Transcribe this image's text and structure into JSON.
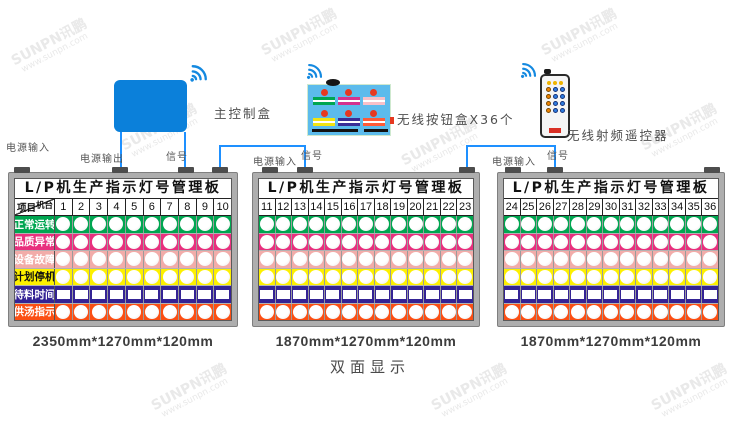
{
  "brand_watermark": {
    "line1": "SUNPN讯鹏",
    "line2": "www.sunpn.com"
  },
  "devices": {
    "control_box_label": "主控制盒",
    "button_box_label": "无线按钮盒X36个",
    "remote_label": "无线射频遥控器"
  },
  "wiring": {
    "power_in_1": "电源输入",
    "power_out": "电源输出",
    "signal_1": "信号",
    "power_in_2": "电源输入",
    "signal_2": "信号",
    "power_in_3": "电源输入",
    "signal_3": "信号"
  },
  "rows": [
    {
      "label": "正常运转",
      "color": "#00A651",
      "text": "#ffffff",
      "shape": "circle"
    },
    {
      "label": "品质异常",
      "color": "#E8307E",
      "text": "#ffffff",
      "shape": "circle"
    },
    {
      "label": "设备故障",
      "color": "#F2ACA9",
      "text": "#ffffff",
      "shape": "circle"
    },
    {
      "label": "计划停机",
      "color": "#FDF000",
      "text": "#111111",
      "shape": "circle"
    },
    {
      "label": "待料时间",
      "color": "#342395",
      "text": "#ffffff",
      "shape": "square"
    },
    {
      "label": "供汤指示",
      "color": "#FB4F14",
      "text": "#ffffff",
      "shape": "circle"
    }
  ],
  "boards": [
    {
      "title": "L/P机生产指示灯号管理板",
      "corner_top": "机台",
      "corner_bottom": "项目",
      "has_labels": true,
      "columns": [
        "1",
        "2",
        "3",
        "4",
        "5",
        "6",
        "7",
        "8",
        "9",
        "10"
      ],
      "dimension": "2350mm*1270mm*120mm"
    },
    {
      "title": "L/P机生产指示灯号管理板",
      "has_labels": false,
      "columns": [
        "11",
        "12",
        "13",
        "14",
        "15",
        "16",
        "17",
        "18",
        "19",
        "20",
        "21",
        "22",
        "23"
      ],
      "dimension": "1870mm*1270mm*120mm"
    },
    {
      "title": "L/P机生产指示灯号管理板",
      "has_labels": false,
      "columns": [
        "24",
        "25",
        "26",
        "27",
        "28",
        "29",
        "30",
        "31",
        "32",
        "33",
        "34",
        "35",
        "36"
      ],
      "dimension": "1870mm*1270mm*120mm"
    }
  ],
  "button_box": {
    "dot_color": "#E63920",
    "bar_colors": [
      "#00A651",
      "#D4328E",
      "#F8C0C8",
      "#F2E411",
      "#3A2E96",
      "#FF5A36"
    ]
  },
  "colors": {
    "wire": "#1E90FF",
    "control_box": "#0B80DA",
    "button_box_bg": "#5CBBEC",
    "board_frame": "#AEAEAE"
  },
  "footer": {
    "note": "双面显示"
  }
}
